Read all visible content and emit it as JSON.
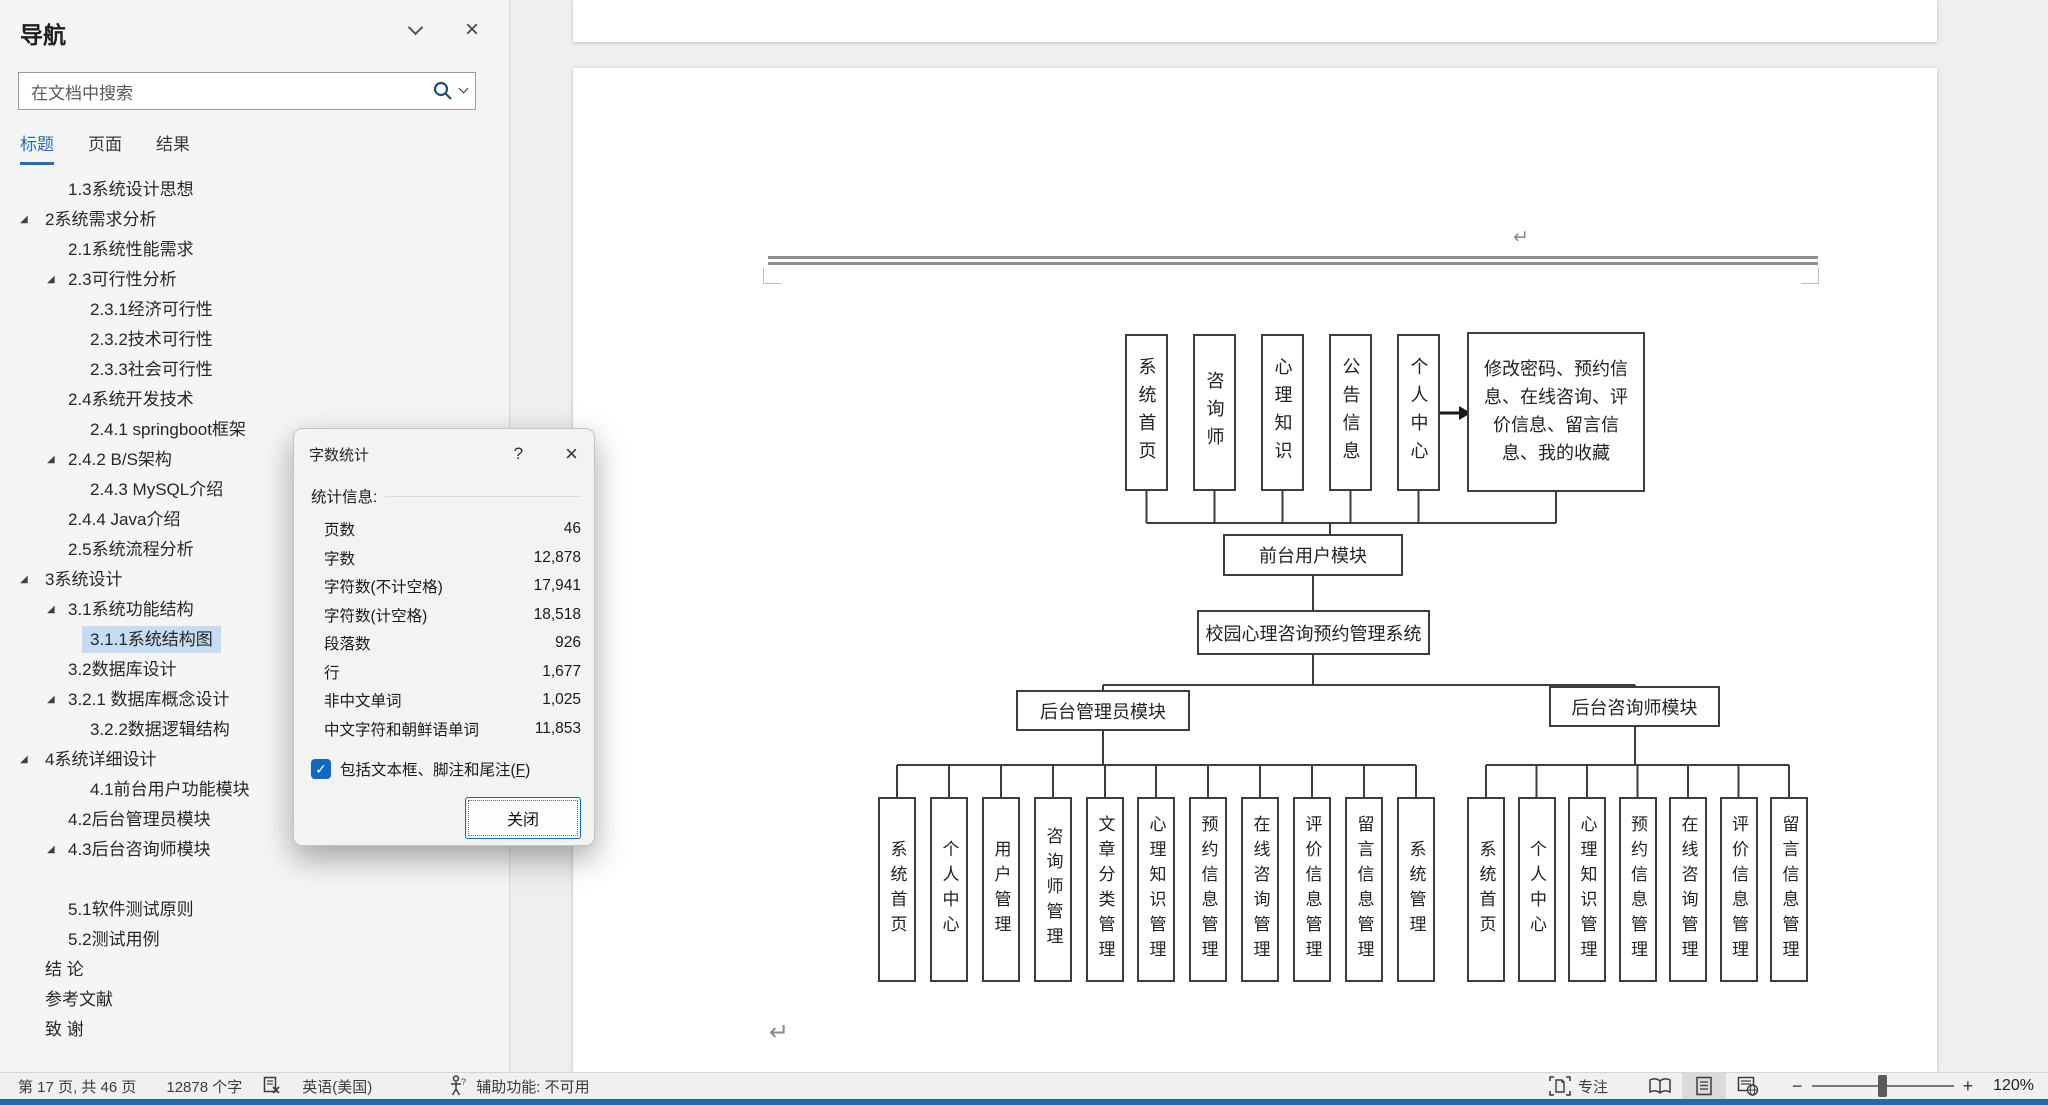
{
  "nav": {
    "title": "导航",
    "search_placeholder": "在文档中搜索",
    "tabs": [
      {
        "label": "标题",
        "active": true
      },
      {
        "label": "页面",
        "active": false
      },
      {
        "label": "结果",
        "active": false
      }
    ],
    "items": [
      {
        "label": "1.3系统设计思想",
        "level": 2
      },
      {
        "label": "2系统需求分析",
        "level": 1,
        "expanded": true
      },
      {
        "label": "2.1系统性能需求",
        "level": 2
      },
      {
        "label": "2.3可行性分析",
        "level": 2,
        "expanded": true
      },
      {
        "label": "2.3.1经济可行性",
        "level": 3
      },
      {
        "label": "2.3.2技术可行性",
        "level": 3
      },
      {
        "label": "2.3.3社会可行性",
        "level": 3
      },
      {
        "label": "2.4系统开发技术",
        "level": 2
      },
      {
        "label": "2.4.1 springboot框架",
        "level": 3
      },
      {
        "label": "2.4.2 B/S架构",
        "level": 2,
        "expanded": true
      },
      {
        "label": "2.4.3 MySQL介绍",
        "level": 3
      },
      {
        "label": "2.4.4 Java介绍",
        "level": 2
      },
      {
        "label": "2.5系统流程分析",
        "level": 2
      },
      {
        "label": "3系统设计",
        "level": 1,
        "expanded": true
      },
      {
        "label": "3.1系统功能结构",
        "level": 2,
        "expanded": true
      },
      {
        "label": "3.1.1系统结构图",
        "level": 3,
        "selected": true
      },
      {
        "label": "3.2数据库设计",
        "level": 2
      },
      {
        "label": "3.2.1 数据库概念设计",
        "level": 2,
        "expanded": true
      },
      {
        "label": "3.2.2数据逻辑结构",
        "level": 3
      },
      {
        "label": "4系统详细设计",
        "level": 1,
        "expanded": true
      },
      {
        "label": "4.1前台用户功能模块",
        "level": 3
      },
      {
        "label": "4.2后台管理员模块",
        "level": 2
      },
      {
        "label": "4.3后台咨询师模块",
        "level": 2,
        "expanded": true
      },
      {
        "label": "",
        "level": 1,
        "spacer": true
      },
      {
        "label": "5.1软件测试原则",
        "level": 2
      },
      {
        "label": "5.2测试用例",
        "level": 2
      },
      {
        "label": "结 论",
        "level": 1
      },
      {
        "label": "参考文献",
        "level": 1
      },
      {
        "label": "致 谢",
        "level": 1
      }
    ]
  },
  "dialog": {
    "title": "字数统计",
    "help_icon": "?",
    "close_icon": "×",
    "section_label": "统计信息:",
    "stats": [
      {
        "label": "页数",
        "value": "46"
      },
      {
        "label": "字数",
        "value": "12,878"
      },
      {
        "label": "字符数(不计空格)",
        "value": "17,941"
      },
      {
        "label": "字符数(计空格)",
        "value": "18,518"
      },
      {
        "label": "段落数",
        "value": "926"
      },
      {
        "label": "行",
        "value": "1,677"
      },
      {
        "label": "非中文单词",
        "value": "1,025"
      },
      {
        "label": "中文字符和朝鲜语单词",
        "value": "11,853"
      }
    ],
    "checkbox": {
      "checked": true,
      "check_glyph": "✓",
      "label_pre": "包括文本框、脚注和尾注(",
      "mnemonic": "F",
      "label_post": ")"
    },
    "close_button": "关闭"
  },
  "document": {
    "pilcrow": "↵",
    "diagram": {
      "root": "校园心理咨询预约管理系统",
      "front_module": "前台用户模块",
      "front_children": [
        "系统首页",
        "咨询师",
        "心理知识",
        "公告信息",
        "个人中心"
      ],
      "front_note": "修改密码、预约信息、在线咨询、评价信息、留言信息、我的收藏",
      "admin_module": "后台管理员模块",
      "admin_children": [
        "系统首页",
        "个人中心",
        "用户管理",
        "咨询师管理",
        "文章分类管理",
        "心理知识管理",
        "预约信息管理",
        "在线咨询管理",
        "评价信息管理",
        "留言信息管理",
        "系统管理"
      ],
      "counselor_module": "后台咨询师模块",
      "counselor_children": [
        "系统首页",
        "个人中心",
        "心理知识管理",
        "预约信息管理",
        "在线咨询管理",
        "评价信息管理",
        "留言信息管理"
      ]
    }
  },
  "status_bar": {
    "page_info": "第 17 页, 共 46 页",
    "word_count": "12878 个字",
    "language": "英语(美国)",
    "accessibility": "辅助功能: 不可用",
    "focus": "专注",
    "zoom_minus": "−",
    "zoom_plus": "+",
    "zoom_level": "120%"
  },
  "colors": {
    "accent_blue": "#2b6cb5",
    "selection_blue": "#c6dcf2",
    "checkbox_blue": "#1266c4",
    "button_border_blue": "#0f6cbd",
    "bottom_strip_blue": "#2a66ad",
    "search_icon_blue": "#1f4e79"
  }
}
